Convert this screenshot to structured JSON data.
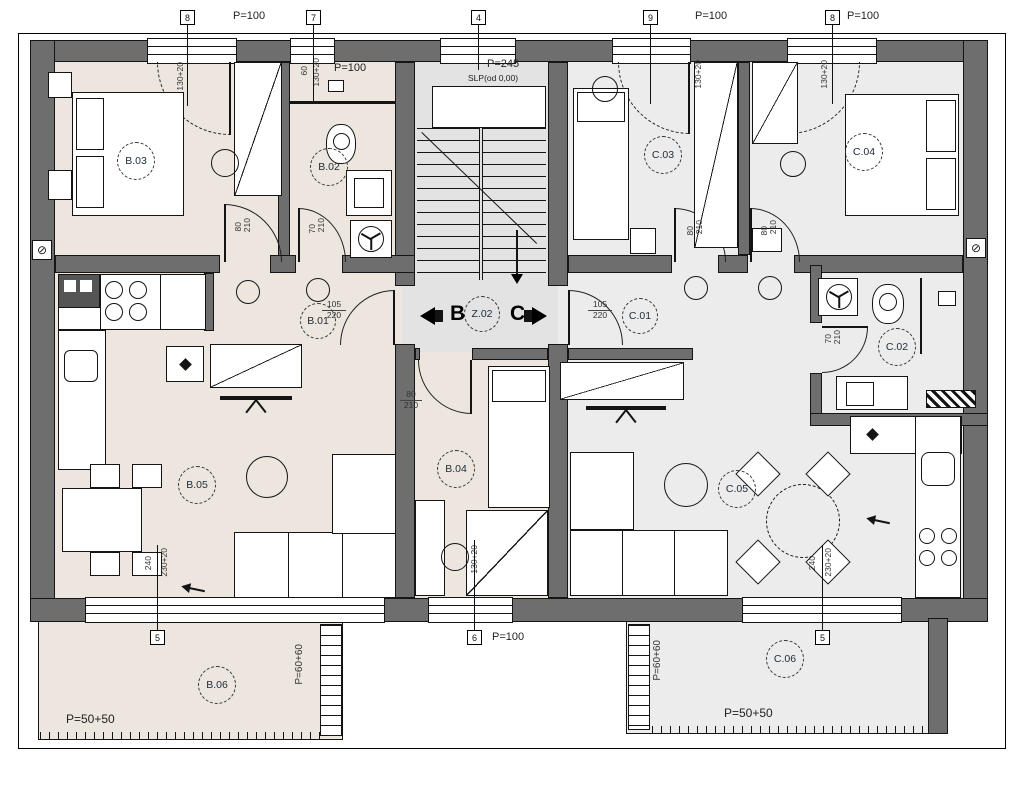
{
  "rooms": {
    "b01": "B.01",
    "b02": "B.02",
    "b03": "B.03",
    "b04": "B.04",
    "b05": "B.05",
    "b06": "B.06",
    "z02": "Z.02",
    "c01": "C.01",
    "c02": "C.02",
    "c03": "C.03",
    "c04": "C.04",
    "c05": "C.05",
    "c06": "C.06"
  },
  "markers": {
    "m8": "8",
    "m7": "7",
    "m4": "4",
    "m9": "9",
    "m5": "5",
    "m6": "6"
  },
  "areas": {
    "p100": "P=100",
    "p245": "P=245",
    "level": "SLP(od 0,00)",
    "p5050": "P=50+50",
    "p6060": "P=60+60"
  },
  "dims": {
    "d80": "80",
    "d70": "70",
    "d210": "210",
    "d105": "105",
    "d220": "220",
    "w60": "60",
    "w130": "130+20",
    "w240": "240",
    "w230": "230+20"
  },
  "nav": {
    "left": "B",
    "right": "C"
  },
  "icons": {
    "drain": "⊘"
  },
  "colors": {
    "wall": "#6e6e6e",
    "apartment_b_floor": "#ece6de",
    "apartment_c_floor": "#ececec",
    "stairs_floor": "#e3e3e3"
  }
}
